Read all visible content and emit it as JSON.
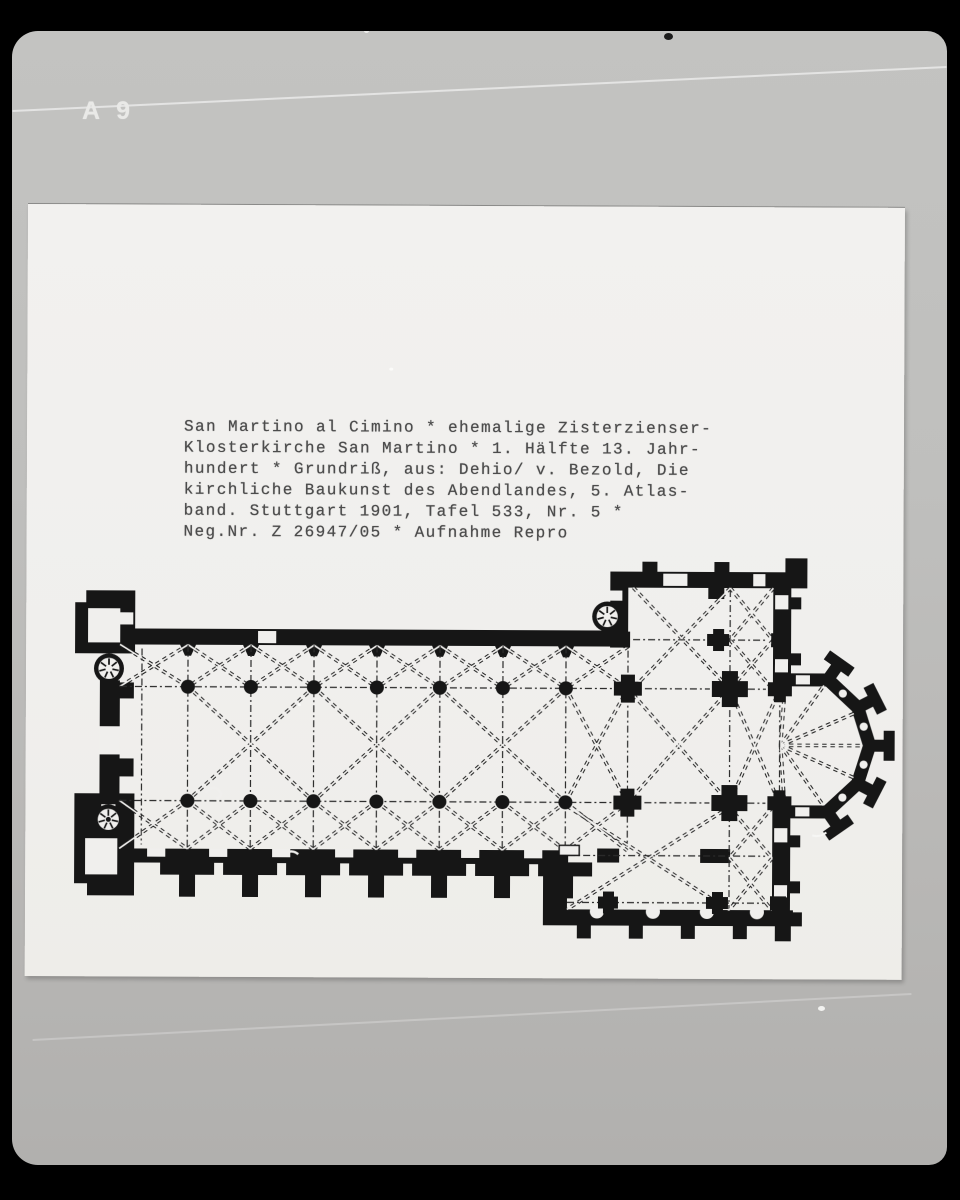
{
  "label": {
    "text": "A 9"
  },
  "caption": {
    "lines": [
      "San Martino al Cimino * ehemalige Zisterzienser-",
      "Klosterkirche San Martino * 1. Hälfte 13. Jahr-",
      "hundert * Grundriß, aus: Dehio/ v. Bezold, Die",
      "kirchliche Baukunst des Abendlandes, 5. Atlas-",
      "band. Stuttgart 1901, Tafel 533, Nr. 5 *",
      "Neg.Nr. Z 26947/05 * Aufnahme Repro"
    ]
  },
  "plan": {
    "subject": "grundriss-floor-plan",
    "features": [
      "west-front-twin-towers-with-spiral-stairs",
      "nave-with-two-column-arcades",
      "south-wall-t-buttresses",
      "north-transept-with-stair-turret",
      "south-transept-with-chapel-arcade",
      "crossing-piers",
      "polygonal-apse-with-radiating-ribs"
    ]
  },
  "colors": {
    "background": "#000000",
    "mat": "#bfbfbd",
    "photo": "#f0efed",
    "ink": "#191919",
    "caption_text": "#4c4c4c",
    "label_text": "#e9e9e7"
  }
}
